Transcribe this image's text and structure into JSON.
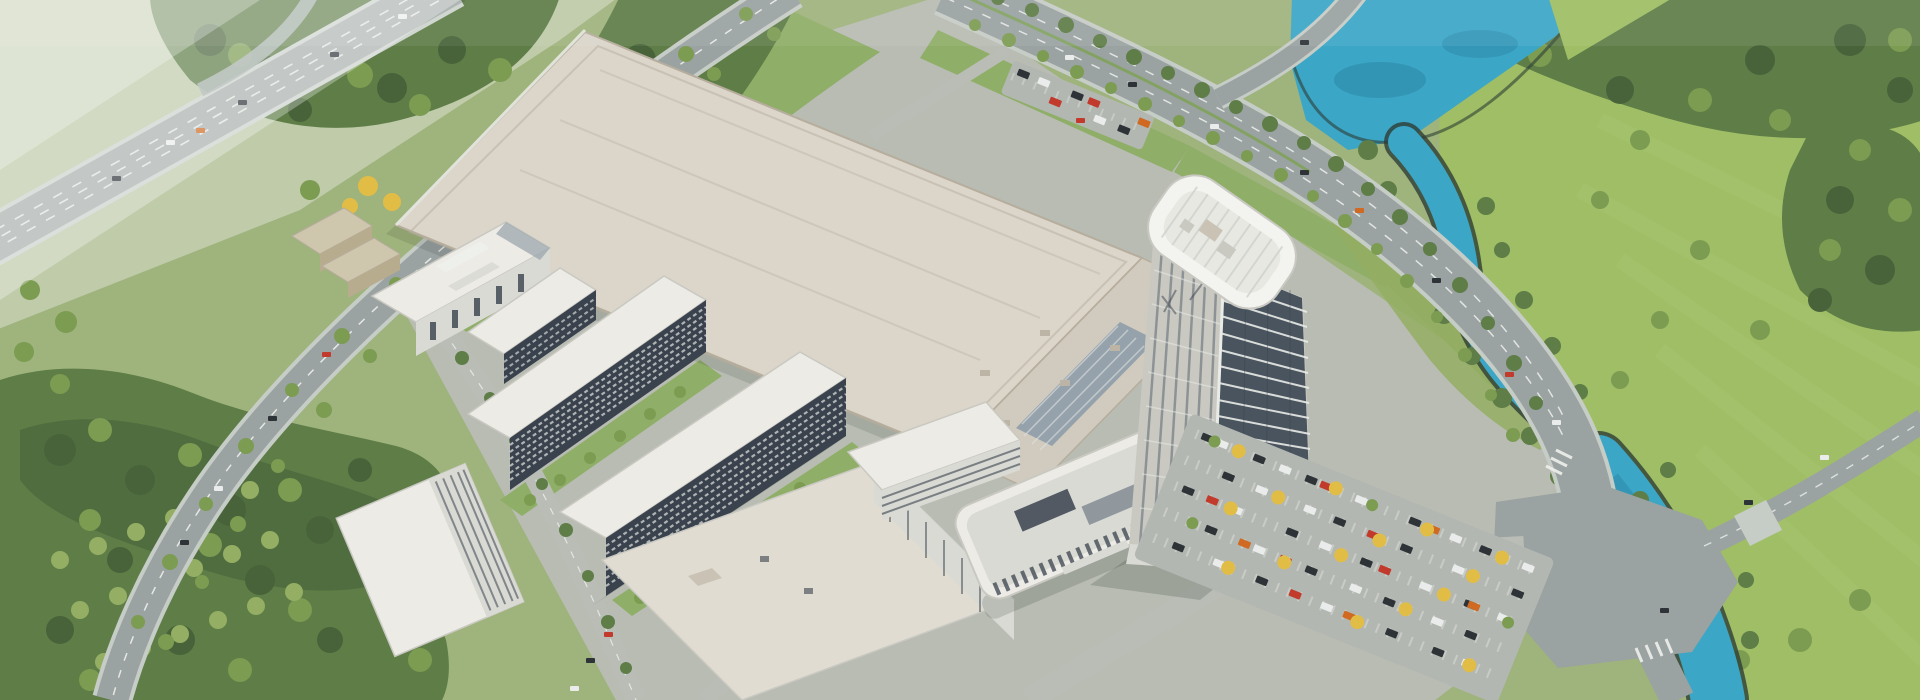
{
  "palette": {
    "ground": "#9fb37c",
    "campus": "#b8bcb2",
    "pale_field": "#bfcba9",
    "meadow": "#9fbe65",
    "meadow_light": "#adc977",
    "lawn": "#8fae68",
    "lawn_dark": "#7da058",
    "forest_dark": "#48633a",
    "forest_mid": "#5e7d47",
    "tree_light": "#7c9c52",
    "tree_pale": "#94ae63",
    "tree_yellow": "#e2bd46",
    "tree_orange": "#d9a332",
    "river": "#3ba6c6",
    "river_deep": "#2c86a6",
    "shore": "#2e3d35",
    "road": "#9aa2a2",
    "road_edge": "#c6ccc6",
    "road_internal": "#b9bdb6",
    "lane": "#eef0ec",
    "median_green": "#7fa257",
    "highway": "#a9b1ae",
    "highway_edge": "#cdd3cd",
    "roof_main": "#dbd5ca",
    "roof_edge": "#b6ad9d",
    "roof_annex": "#d1cbbf",
    "roof_canteen": "#e1dcd2",
    "roof_block": "#cac3b5",
    "atrium": "#96a2ab",
    "atrium_slat": "#dfe3e4",
    "facade_white": "#edebe5",
    "facade_gray": "#d9dad4",
    "facade_shade": "#c9c9c2",
    "window_dark": "#39424d",
    "beige": "#cfc6ae",
    "beige_dark": "#b8ac8f",
    "vent": "#bcb4a5",
    "glass_gray": "#727c86",
    "tower_white": "#eef0ec",
    "tower_crown": "#f3f4f0",
    "tower_deck": "#e7e8e2",
    "tower_glass": "#49545f",
    "tower_line": "#e9ebe7",
    "tower_mullion": "#525e6a",
    "tower_fin": "#cfd2cc",
    "parking": "#b3b7b1",
    "stall": "#e3e5e1",
    "car_dark": "#2e3338",
    "car_white": "#eaebeb",
    "car_red": "#c13a2b",
    "car_orange": "#d06a22",
    "fog": "#ffffff",
    "shadow": "#1f2a1f"
  }
}
